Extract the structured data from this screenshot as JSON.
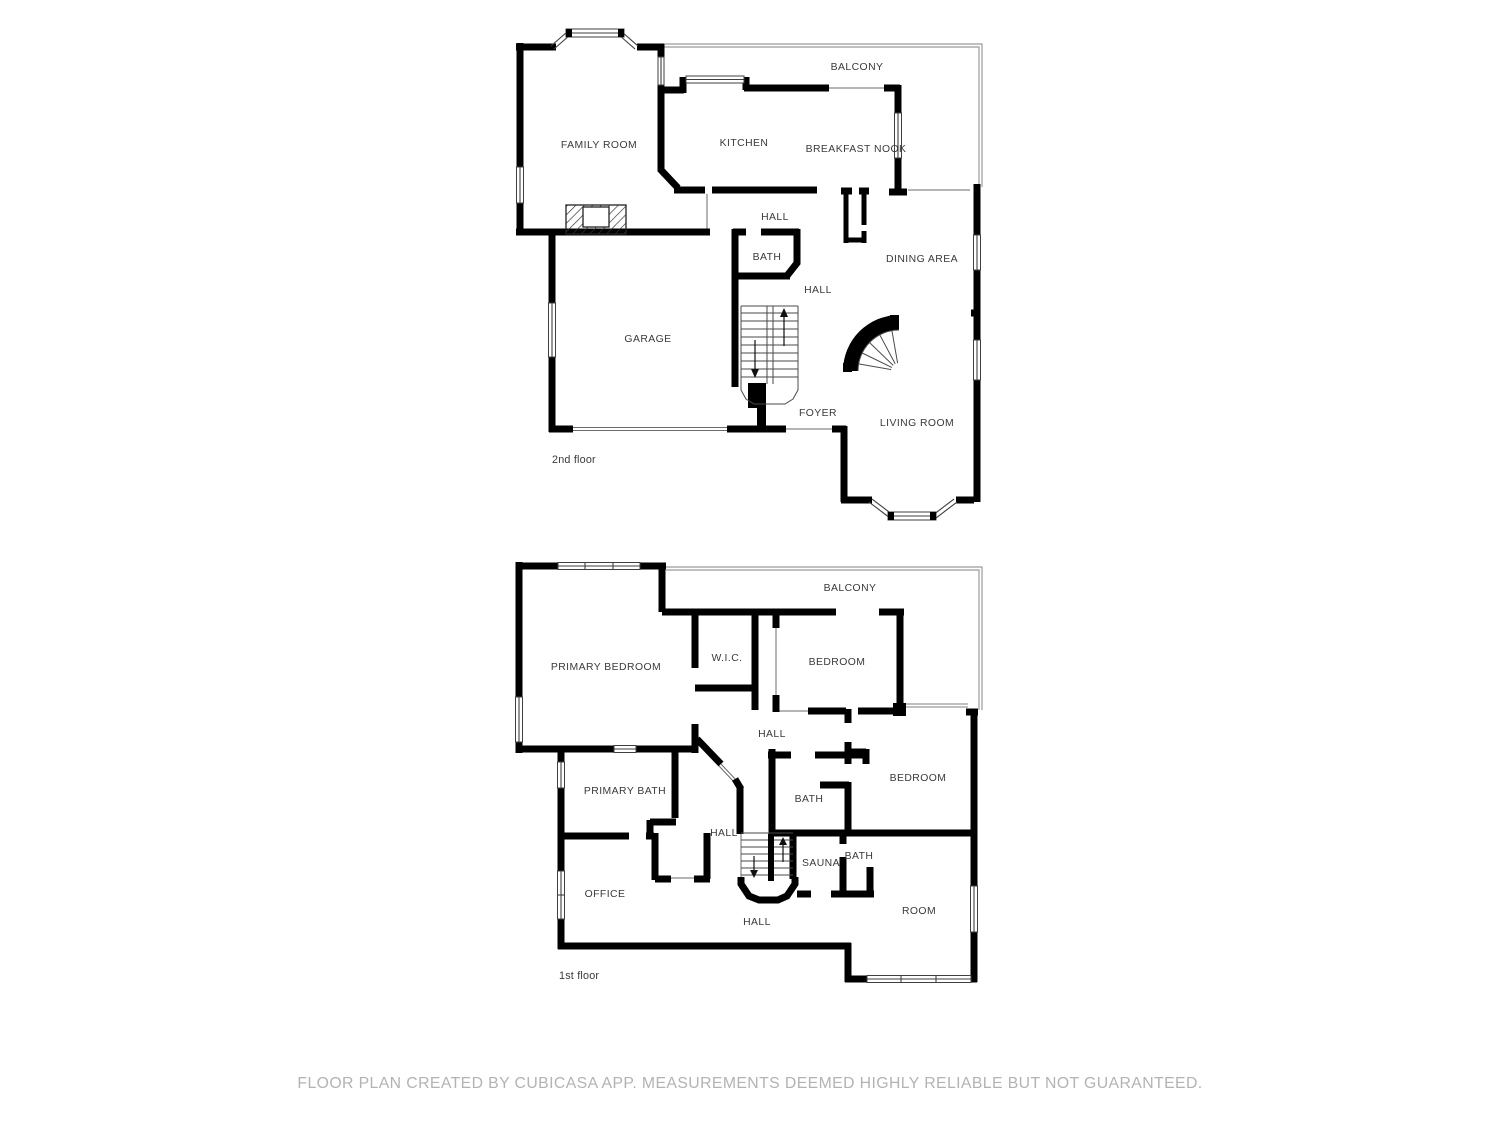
{
  "document": {
    "type": "floor-plan",
    "creator_note": "FLOOR PLAN CREATED BY CUBICASA APP. MEASUREMENTS DEEMED HIGHLY RELIABLE BUT NOT GUARANTEED."
  },
  "colors": {
    "background": "#ffffff",
    "wall": "#000000",
    "thin_line": "#3f3f3f",
    "railing": "#9b9b9b",
    "label_text": "#3a3a3a",
    "footer_text": "#b3b3b3"
  },
  "floors": {
    "second": {
      "caption": "2nd floor",
      "rooms": {
        "balcony": "BALCONY",
        "family_room": "FAMILY ROOM",
        "kitchen": "KITCHEN",
        "breakfast_nook": "BREAKFAST NOOK",
        "hall_upper": "HALL",
        "bath": "BATH",
        "dining_area": "DINING AREA",
        "hall_lower": "HALL",
        "garage": "GARAGE",
        "foyer": "FOYER",
        "living_room": "LIVING ROOM"
      }
    },
    "first": {
      "caption": "1st floor",
      "rooms": {
        "balcony": "BALCONY",
        "primary_bedroom": "PRIMARY BEDROOM",
        "wic": "W.I.C.",
        "bedroom_upper": "BEDROOM",
        "hall_upper": "HALL",
        "primary_bath": "PRIMARY BATH",
        "bath_center": "BATH",
        "bedroom_right": "BEDROOM",
        "hall_middle": "HALL",
        "office": "OFFICE",
        "sauna": "SAUNA",
        "bath_small": "BATH",
        "hall_lower": "HALL",
        "room": "ROOM"
      }
    }
  },
  "footer": {
    "text": "FLOOR PLAN CREATED BY CUBICASA APP. MEASUREMENTS DEEMED HIGHLY RELIABLE BUT NOT GUARANTEED."
  }
}
